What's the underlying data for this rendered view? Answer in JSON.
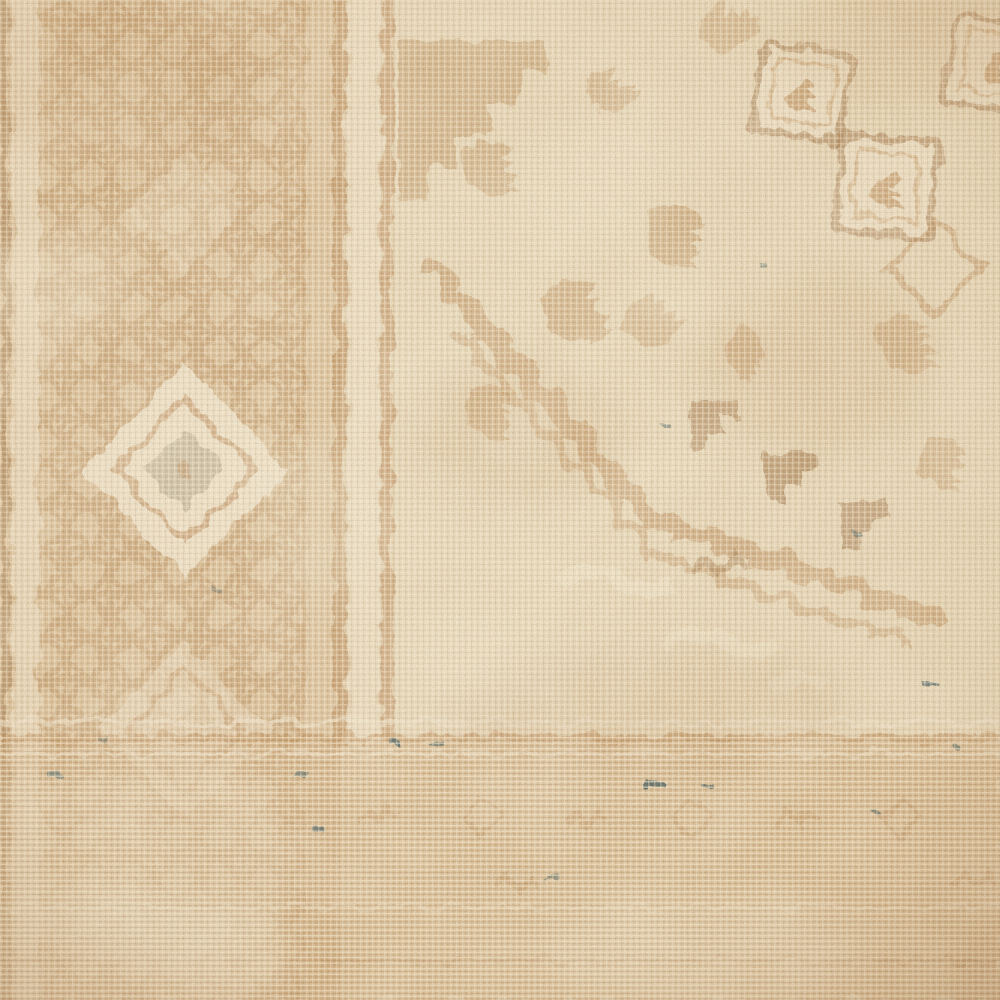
{
  "image": {
    "medium": "photograph",
    "subject": "Vintage hand-knotted rug, close-up detail",
    "alt_text": "Extreme close-up of a faded antique Persian-style rug woven in washed-out cream and tan wool. A geometric left border band with a concentric diamond medallion runs vertically, separated from the central field by double guard stripes. The field shows a large medallion with serrated sawtooth diagonal edges, stepped motifs, rotated diamond boxes in the upper right, and scattered serrated leaf ornaments. A striated horizontal border band crosses the bottom with tiny dark teal thread flecks. The woven grid texture and heavy wear patches are visible throughout.",
    "style": "distressed, low-contrast, heavily faded neutral tones",
    "visible_text": ""
  },
  "palette": {
    "base_cream": "#e8d8b8",
    "field_cream": "#eee2c6",
    "light_cream": "#f6eeda",
    "border_tan": "#d3ae7f",
    "tan": "#c29460",
    "dark_tan": "#a5794a",
    "deep_brown": "#8a6134",
    "grey_wash": "#b4ab92",
    "teal_fleck": "#3e5d63"
  },
  "regions": [
    {
      "id": "left-border-band",
      "label": "Left border band",
      "description": "Vertical border strip with dense tan diamond-lattice ornament and a cream concentric diamond medallion midway down; pale worn area toward the bottom left corner."
    },
    {
      "id": "guard-stripes",
      "label": "Guard stripes",
      "description": "Two thin vertical tan guard lines with a cream channel between them separating the border from the field, plus a narrow cream selvedge stripe at the far left edge."
    },
    {
      "id": "central-field",
      "label": "Central field",
      "description": "Cream open field scattered with faded serrated leaf and scroll motifs in tan."
    },
    {
      "id": "medallion-corner",
      "label": "Medallion corner",
      "description": "Large central medallion entering from the right; its edge is a sawtooth serrated diagonal band stepping from upper centre down to the right edge, with darker stepped teeth and cream scroll ornaments inside."
    },
    {
      "id": "diamond-boxes",
      "label": "Diamond boxes",
      "description": "Slightly rotated square boxes outlined in tan with small curled bird-like glyphs inside, upper right area."
    },
    {
      "id": "bottom-border-band",
      "label": "Bottom border band",
      "description": "Horizontal striated border band across the bottom quarter with faint repeating diamond and zigzag motifs and thin cream rules."
    },
    {
      "id": "teal-flecks",
      "label": "Teal thread flecks",
      "description": "Small dark blue-green knots of surviving pile scattered mostly along the bottom band and medallion."
    },
    {
      "id": "weave-texture",
      "label": "Weave texture",
      "description": "Fine warp/weft grid of the foundation visible through the worn pile, with mottled grain and large soft wear patches."
    }
  ]
}
